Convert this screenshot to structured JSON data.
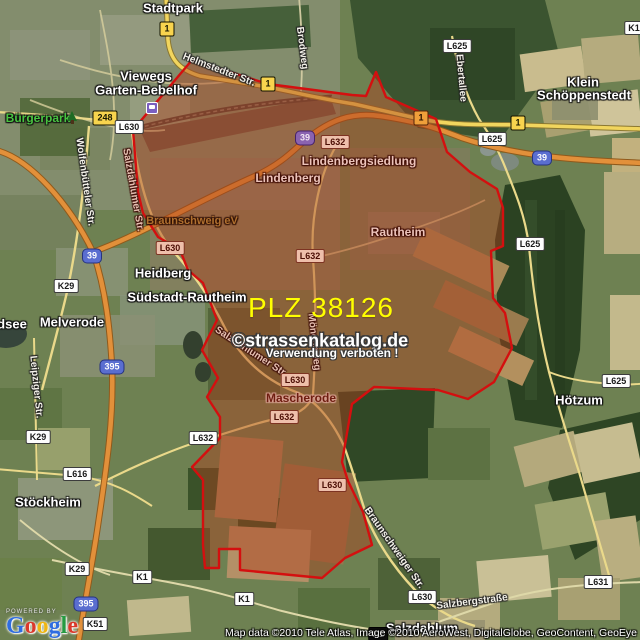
{
  "watermark": {
    "plz": "PLZ 38126",
    "site": "©strassenkatalog.de",
    "warning": "Verwendung verboten !"
  },
  "attribution": {
    "powered_by": "POWERED BY",
    "logo": "Google",
    "copyright": "Map data ©2010 Tele Atlas, Image ©2010 AeroWest, DigitalGlobe, GeoContent, GeoEye"
  },
  "colors": {
    "boundary_red": "#d40f0f",
    "overlay_fill": "#b03e1c",
    "watermark_yellow": "#ffff00"
  },
  "shields": [
    {
      "label": "1",
      "type": "yellow",
      "x": 167,
      "y": 29
    },
    {
      "label": "1",
      "type": "yellow",
      "x": 268,
      "y": 84
    },
    {
      "label": "1",
      "type": "yellow",
      "x": 421,
      "y": 118,
      "tinted": true
    },
    {
      "label": "1",
      "type": "yellow",
      "x": 518,
      "y": 123
    },
    {
      "label": "248",
      "type": "yellow",
      "x": 105,
      "y": 118
    },
    {
      "label": "39",
      "type": "blue",
      "x": 92,
      "y": 256
    },
    {
      "label": "39",
      "type": "blue",
      "x": 305,
      "y": 138,
      "tinted": true
    },
    {
      "label": "39",
      "type": "blue",
      "x": 542,
      "y": 158
    },
    {
      "label": "395",
      "type": "blue",
      "x": 112,
      "y": 367
    },
    {
      "label": "395",
      "type": "blue",
      "x": 86,
      "y": 604
    },
    {
      "label": "L630",
      "type": "white",
      "x": 129,
      "y": 127
    },
    {
      "label": "L630",
      "type": "white",
      "x": 170,
      "y": 248,
      "tinted": true
    },
    {
      "label": "L630",
      "type": "white",
      "x": 295,
      "y": 380,
      "tinted": true
    },
    {
      "label": "L630",
      "type": "white",
      "x": 332,
      "y": 485,
      "tinted": true
    },
    {
      "label": "L630",
      "type": "white",
      "x": 422,
      "y": 597
    },
    {
      "label": "L632",
      "type": "white",
      "x": 335,
      "y": 142,
      "tinted": true
    },
    {
      "label": "L632",
      "type": "white",
      "x": 310,
      "y": 256,
      "tinted": true
    },
    {
      "label": "L632",
      "type": "white",
      "x": 284,
      "y": 417,
      "tinted": true
    },
    {
      "label": "L632",
      "type": "white",
      "x": 203,
      "y": 438
    },
    {
      "label": "L625",
      "type": "white",
      "x": 457,
      "y": 46
    },
    {
      "label": "L625",
      "type": "white",
      "x": 492,
      "y": 139
    },
    {
      "label": "L625",
      "type": "white",
      "x": 530,
      "y": 244
    },
    {
      "label": "L625",
      "type": "white",
      "x": 616,
      "y": 381
    },
    {
      "label": "L631",
      "type": "white",
      "x": 598,
      "y": 582
    },
    {
      "label": "L616",
      "type": "white",
      "x": 77,
      "y": 474
    },
    {
      "label": "K29",
      "type": "white",
      "x": 66,
      "y": 286
    },
    {
      "label": "K29",
      "type": "white",
      "x": 38,
      "y": 437
    },
    {
      "label": "K29",
      "type": "white",
      "x": 77,
      "y": 569
    },
    {
      "label": "K51",
      "type": "white",
      "x": 95,
      "y": 624
    },
    {
      "label": "K1",
      "type": "white",
      "x": 142,
      "y": 577
    },
    {
      "label": "K1",
      "type": "white",
      "x": 244,
      "y": 599
    },
    {
      "label": "K1",
      "type": "white",
      "x": 634,
      "y": 28
    },
    {
      "label": "K1",
      "type": "dark",
      "x": 378,
      "y": 634
    }
  ],
  "places": [
    {
      "name": "Stadtpark",
      "x": 173,
      "y": 8,
      "cls": ""
    },
    {
      "name": "Viewegs",
      "x": 146,
      "y": 76,
      "cls": ""
    },
    {
      "name": "Garten-Bebelhof",
      "x": 146,
      "y": 90,
      "cls": ""
    },
    {
      "name": "Bürgerpark",
      "x": 38,
      "y": 118,
      "cls": "green"
    },
    {
      "name": "Klein",
      "x": 583,
      "y": 82,
      "cls": ""
    },
    {
      "name": "Schöppenstedt",
      "x": 584,
      "y": 95,
      "cls": ""
    },
    {
      "name": "Heidberg",
      "x": 163,
      "y": 273,
      "cls": ""
    },
    {
      "name": "Südstadt-Rautheim",
      "x": 187,
      "y": 297,
      "cls": ""
    },
    {
      "name": "Melverode",
      "x": 72,
      "y": 322,
      "cls": ""
    },
    {
      "name": "dsee",
      "x": 12,
      "y": 324,
      "cls": ""
    },
    {
      "name": "Stöckheim",
      "x": 48,
      "y": 502,
      "cls": ""
    },
    {
      "name": "Hötzum",
      "x": 579,
      "y": 400,
      "cls": ""
    },
    {
      "name": "Salzdahlum",
      "x": 422,
      "y": 628,
      "cls": ""
    },
    {
      "name": "Lindenbergsiedlung",
      "x": 359,
      "y": 161,
      "cls": "pink"
    },
    {
      "name": "Lindenberg",
      "x": 288,
      "y": 178,
      "cls": "pink"
    },
    {
      "name": "Rautheim",
      "x": 398,
      "y": 232,
      "cls": "pink"
    },
    {
      "name": "Braunschweig eV",
      "x": 192,
      "y": 221,
      "cls": "poi"
    },
    {
      "name": "Mascherode",
      "x": 301,
      "y": 398,
      "cls": "maroon"
    }
  ],
  "streets": [
    {
      "name": "Helmstedter Str.",
      "x": 219,
      "y": 70,
      "rot": 21,
      "cls": ""
    },
    {
      "name": "Brodweg",
      "x": 302,
      "y": 48,
      "rot": 83,
      "cls": ""
    },
    {
      "name": "Ebertallee",
      "x": 461,
      "y": 78,
      "rot": 85,
      "cls": ""
    },
    {
      "name": "Wolfenbütteler Str.",
      "x": 85,
      "y": 182,
      "rot": 82,
      "cls": ""
    },
    {
      "name": "Salzdahlumer Str.",
      "x": 133,
      "y": 190,
      "rot": 80,
      "cls": "pink"
    },
    {
      "name": "Salzdahlumer Str.",
      "x": 251,
      "y": 352,
      "rot": 33,
      "cls": "pink"
    },
    {
      "name": "Möncheweg",
      "x": 314,
      "y": 342,
      "rot": 84,
      "cls": "pink"
    },
    {
      "name": "Leipziger Str.",
      "x": 36,
      "y": 387,
      "rot": 84,
      "cls": ""
    },
    {
      "name": "Braunschweiger Str.",
      "x": 394,
      "y": 548,
      "rot": 55,
      "cls": ""
    },
    {
      "name": "Salzbergstraße",
      "x": 472,
      "y": 602,
      "rot": -7,
      "cls": ""
    }
  ],
  "icons": [
    {
      "name": "tree-icon",
      "kind": "tree",
      "x": 72,
      "y": 116
    },
    {
      "name": "station-icon",
      "kind": "station",
      "x": 152,
      "y": 108
    }
  ]
}
